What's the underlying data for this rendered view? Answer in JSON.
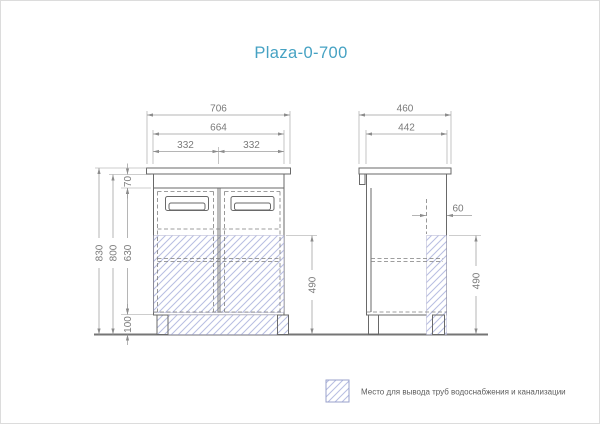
{
  "title": "Plaza-0-700",
  "front_view": {
    "dimensions": {
      "total_width": "706",
      "carcass_width": "664",
      "left_door_width": "332",
      "right_door_width": "332",
      "total_height": "830",
      "carcass_height": "800",
      "door_height": "630",
      "top_panel_height": "70",
      "leg_height": "100",
      "pipe_zone_height": "490"
    }
  },
  "side_view": {
    "dimensions": {
      "total_depth": "460",
      "carcass_depth": "442",
      "pipe_zone_depth": "60",
      "pipe_zone_height": "490"
    }
  },
  "legend": {
    "pipe_zone_label": "Место для вывода труб водоснабжения и канализации"
  },
  "colors": {
    "title_accent": "#46a2c3",
    "hatch_line": "#b7bde2",
    "drawing_outline": "#696969",
    "dimension_gray": "#8c8c8c"
  }
}
